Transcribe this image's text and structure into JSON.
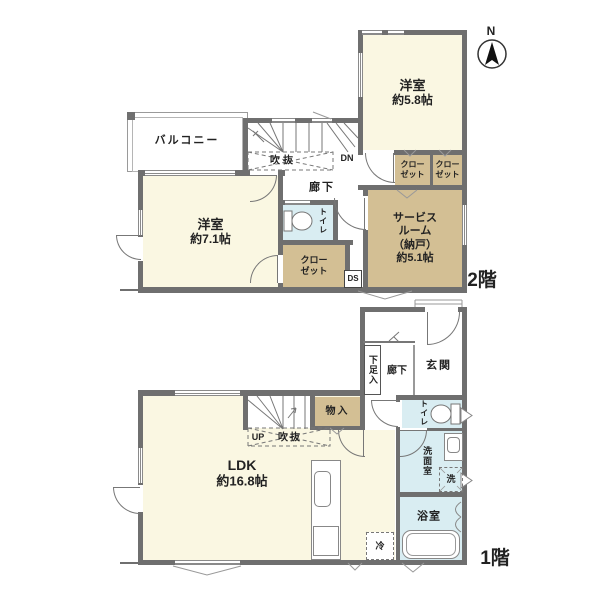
{
  "colors": {
    "wall": "#6f6f6f",
    "room_cream": "#FAF7E2",
    "room_tan": "#D3BF94",
    "room_blue": "#D9EDF2",
    "line_gray": "#8a8a8a",
    "text": "#222222"
  },
  "compass": {
    "north_label": "N"
  },
  "floor2": {
    "floor_label": "2階",
    "balcony": "バルコニー",
    "bedroom_58": {
      "name": "洋室",
      "size": "約5.8帖"
    },
    "bedroom_71": {
      "name": "洋室",
      "size": "約7.1帖"
    },
    "service_room": {
      "l1": "サービス",
      "l2": "ルーム",
      "l3": "（納戸）",
      "l4": "約5.1帖"
    },
    "closet_top_a": {
      "l1": "クロー",
      "l2": "ゼット"
    },
    "closet_top_b": {
      "l1": "クロー",
      "l2": "ゼット"
    },
    "closet_side": {
      "l1": "クロー",
      "l2": "ゼット"
    },
    "toilet": "トイレ",
    "hallway": "廊下",
    "void": "吹抜",
    "down": "DN",
    "duct": "DS"
  },
  "floor1": {
    "floor_label": "1階",
    "ldk": {
      "name": "LDK",
      "size": "約16.8帖"
    },
    "entrance": "玄関",
    "shoe_storage": "下足入",
    "hallway": "廊下",
    "toilet": "トイレ",
    "storage": "物入",
    "up": "UP",
    "void": "吹抜",
    "washroom": "洗面室",
    "washer": "洗",
    "bathroom": "浴室",
    "refrigerator": "冷"
  }
}
